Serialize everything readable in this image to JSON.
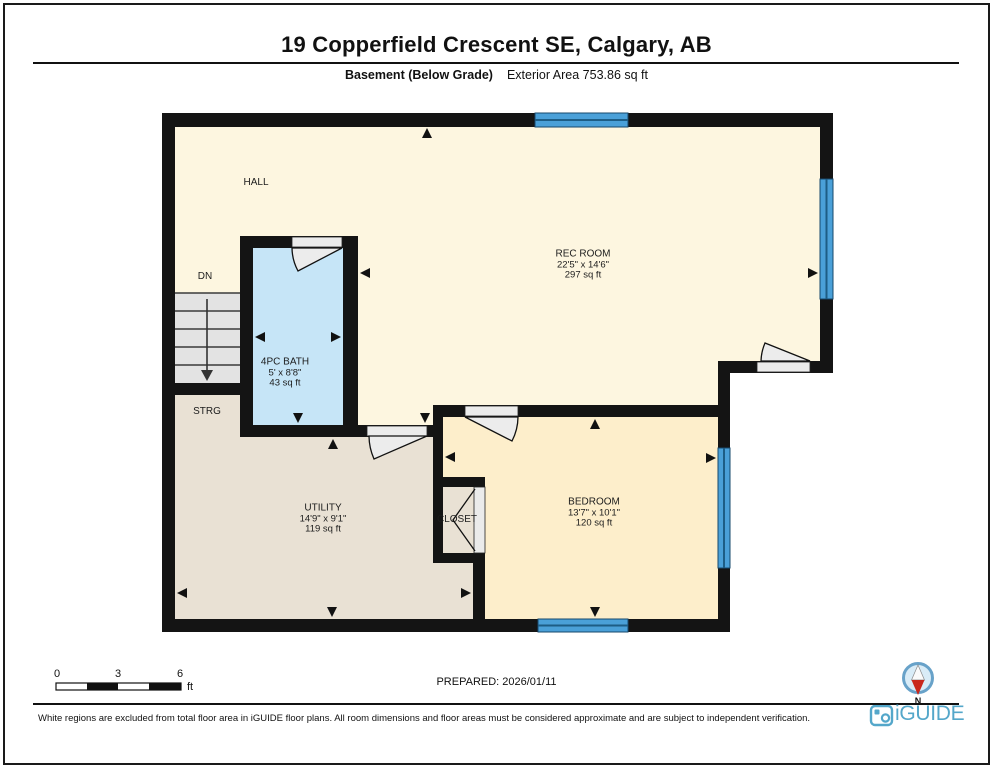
{
  "page": {
    "title": "19 Copperfield Crescent SE, Calgary, AB",
    "floor_label": "Basement (Below Grade)",
    "area_label": "Exterior Area 753.86 sq ft",
    "prepared_label": "PREPARED: 2026/01/11",
    "disclaimer": "White regions are excluded from total floor area in iGUIDE floor plans. All room dimensions and floor areas must be considered approximate and are subject to independent verification."
  },
  "rooms": {
    "hall": {
      "name": "HALL"
    },
    "rec": {
      "name": "REC ROOM",
      "dimensions": "22'5\" x 14'6\"",
      "area": "297 sq ft"
    },
    "bath": {
      "name": "4PC BATH",
      "dimensions": "5' x 8'8\"",
      "area": "43 sq ft"
    },
    "utility": {
      "name": "UTILITY",
      "dimensions": "14'9\" x 9'1\"",
      "area": "119 sq ft"
    },
    "bedroom": {
      "name": "BEDROOM",
      "dimensions": "13'7\" x 10'1\"",
      "area": "120 sq ft"
    },
    "closet": {
      "name": "CLOSET"
    },
    "strg": {
      "name": "STRG"
    },
    "stairs": {
      "name": "DN"
    }
  },
  "scale_bar": {
    "tick0": "0",
    "tick1": "3",
    "tick2": "6",
    "unit": "ft"
  },
  "compass": {
    "label": "N"
  },
  "brand": {
    "name": "iGUIDE"
  },
  "colors": {
    "wall": "#141414",
    "floor_hall": "#fdf6e0",
    "floor_bedroom": "#fdeecb",
    "floor_utility": "#e9e1d4",
    "floor_bath": "#c6e5f7",
    "window_blue": "#4aa0d8",
    "window_line": "#1d5d85",
    "door_gray": "#ebebeb",
    "stairs_gray": "#e3e3e3",
    "brand_blue": "#54a7ca",
    "compass_red": "#c9281c"
  }
}
